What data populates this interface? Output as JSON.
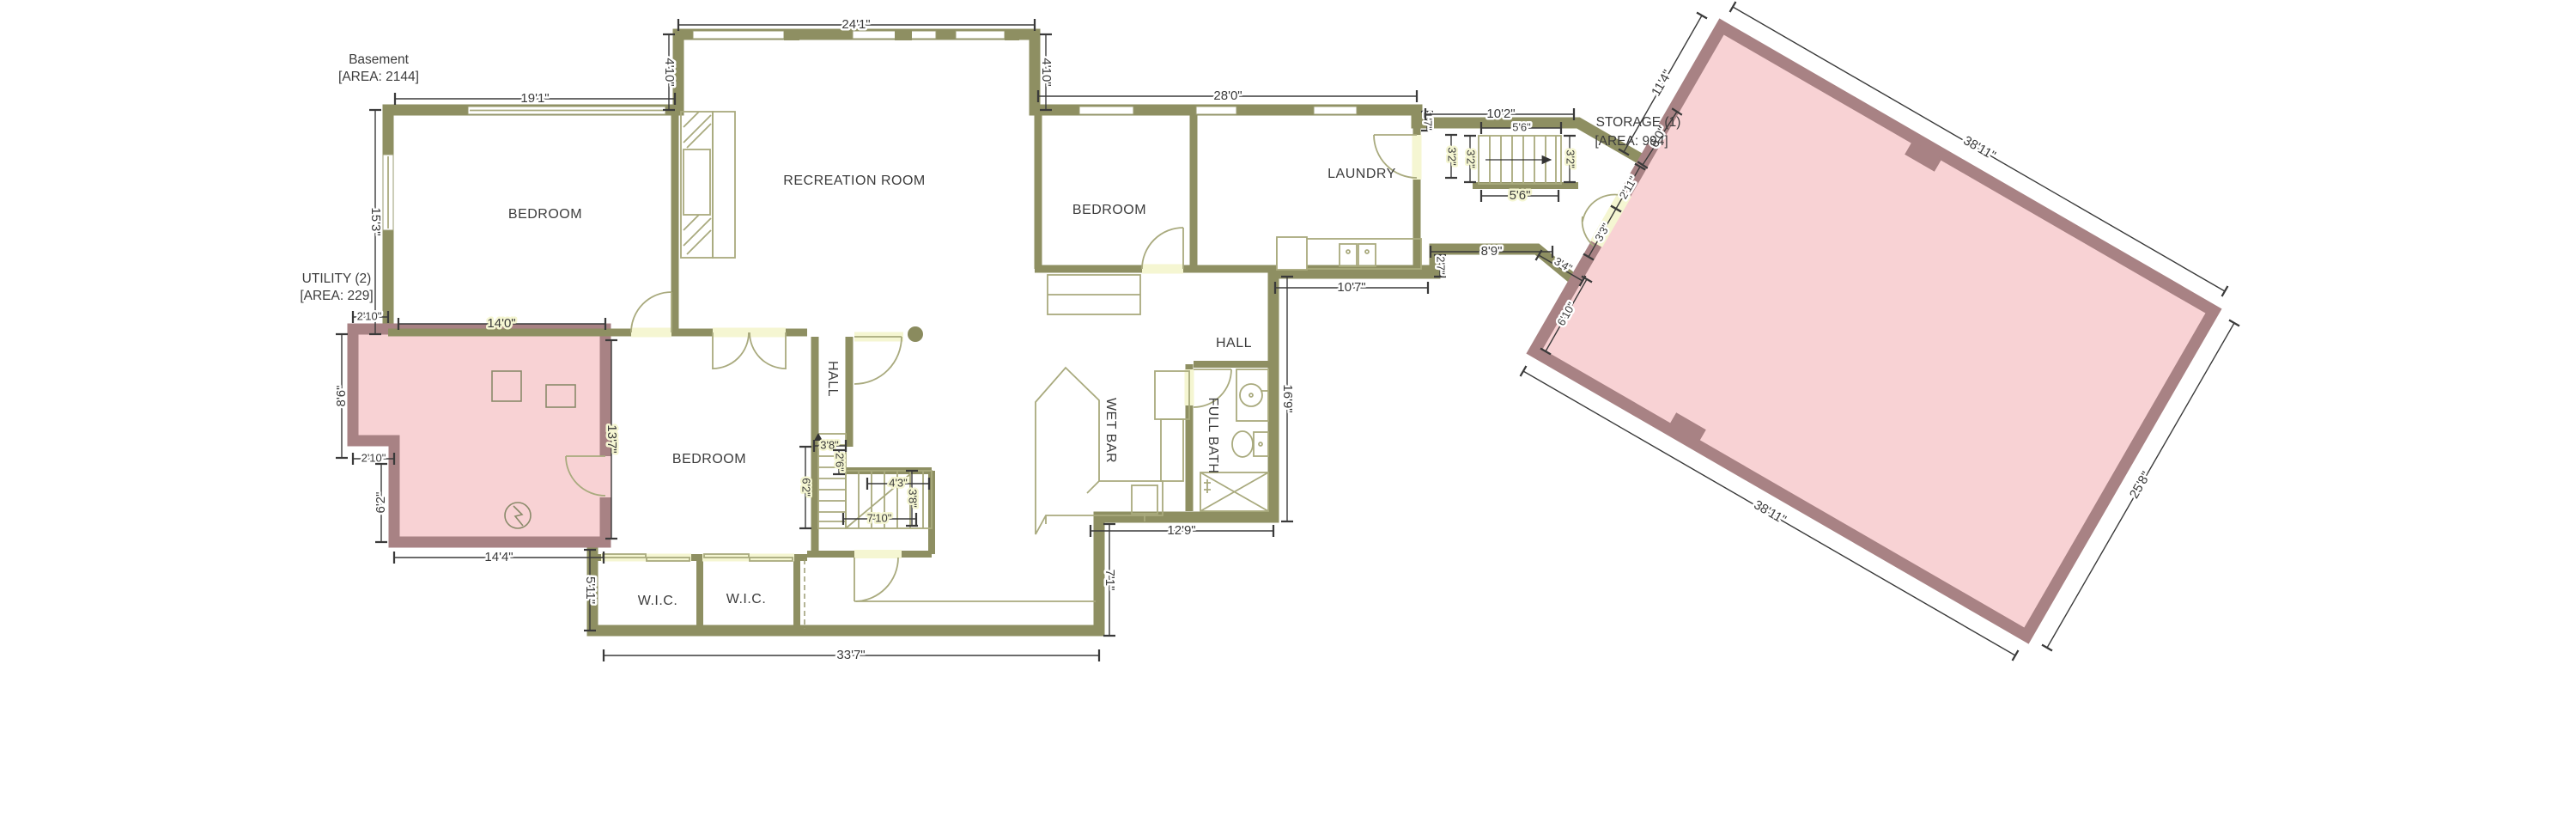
{
  "plan": {
    "title": {
      "line1": "Basement",
      "line2": "[AREA: 2144]"
    },
    "colors": {
      "room_fill": "#f5f6d2",
      "wall": "#8e8f62",
      "pink_fill": "#f8d2d4",
      "pink_wall": "#a88284",
      "dim_text": "#3a3a3a",
      "fixture_line": "#a9aa7e"
    },
    "rooms": {
      "bedroom_left": "BEDROOM",
      "recreation": "RECREATION ROOM",
      "bedroom_right": "BEDROOM",
      "laundry": "LAUNDRY",
      "bedroom_center": "BEDROOM",
      "hall_center": "HALL",
      "hall_right": "HALL",
      "wet_bar": "WET BAR",
      "full_bath": "FULL BATH",
      "wic_left": "W.I.C.",
      "wic_right": "W.I.C.",
      "utility": {
        "line1": "UTILITY (2)",
        "line2": "[AREA: 229]"
      },
      "storage": {
        "line1": "STORAGE (1)",
        "line2": "[AREA: 994]"
      }
    },
    "dimensions": {
      "bedroom_left_top": "19'1\"",
      "recreation_top": "24'1\"",
      "recreation_offset_left": "4'10\"",
      "recreation_offset_right": "4'10\"",
      "right_wing_top": "28'0\"",
      "bedroom_left_height": "15'3\"",
      "utility_top_inset": "2'10\"",
      "utility_top_width": "14'0\"",
      "utility_left_height": "8'6\"",
      "utility_notch_width": "2'10\"",
      "utility_notch_height": "6'2\"",
      "utility_bottom_width": "14'4\"",
      "bedroom_center_height": "13'7\"",
      "wic_left_height": "5'11\"",
      "bottom_width": "33'7\"",
      "bottom_step_height": "7'1\"",
      "bath_wing_bottom": "12'9\"",
      "right_side_height": "16'9\"",
      "laundry_bottom": "10'7\"",
      "laundry_step": "2'7\"",
      "vestibule_bottom": "8'9\"",
      "corridor_bottom_offset": "3'4\"",
      "laundry_top_step": "1'7\"",
      "laundry_door": "3'2\"",
      "stair_top_width": "10'2\"",
      "stair_run_top": "5'6\"",
      "stair_width_left": "3'2\"",
      "stair_width_right": "3'2\"",
      "stair_run_bottom": "5'6\"",
      "hall_stair_width": "3'8\"",
      "hall_stair_landing": "2'6\"",
      "hall_stair_run": "6'2\"",
      "lower_stair_run": "4'3\"",
      "lower_stair_width": "3'8\"",
      "lower_stair_total": "7'10\"",
      "corridor_length": "11'4\"",
      "corridor_width": "6'0\"",
      "storage_jamb_upper": "2'11\"",
      "storage_jamb_lower": "3'3\"",
      "storage_west_lower": "6'10\"",
      "storage_top": "38'11\"",
      "storage_right": "25'8\"",
      "storage_bottom": "38'11\""
    }
  }
}
